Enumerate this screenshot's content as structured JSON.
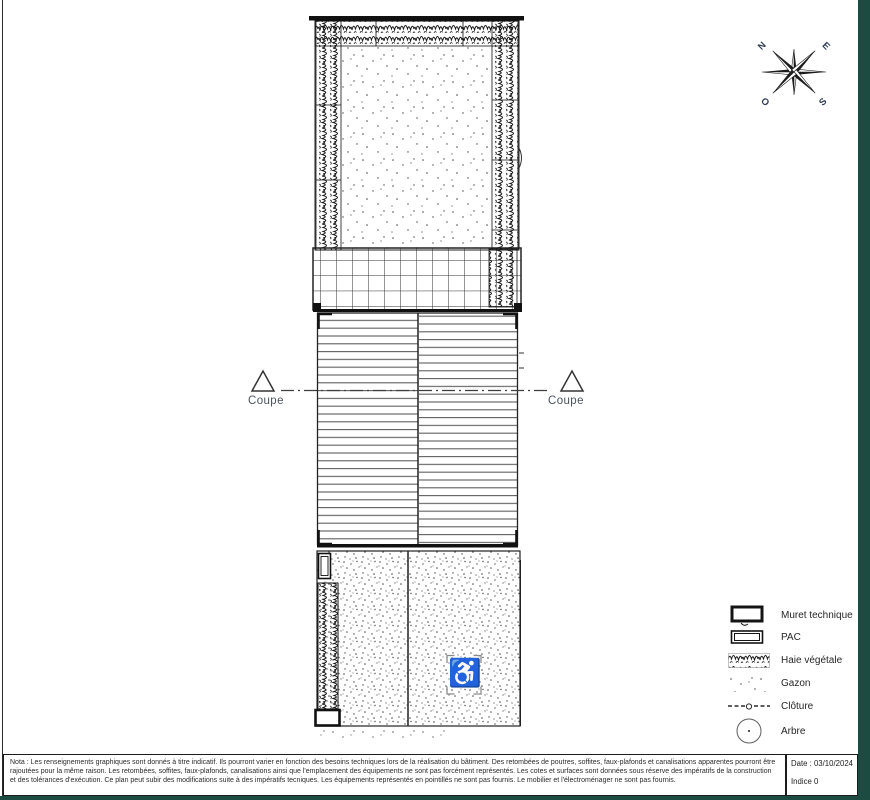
{
  "colors": {
    "frame_teal": "#1c4b42",
    "line_dark": "#1a1a1a",
    "roof_line_gray": "#5d5d5d",
    "label_gray_blue": "#4c545e"
  },
  "compass": {
    "n": "N",
    "e": "E",
    "s": "S",
    "o": "O"
  },
  "section_markers": {
    "left_label": "Coupe",
    "right_label": "Coupe"
  },
  "plan": {
    "accessible_icon": "♿"
  },
  "legend": {
    "items": [
      {
        "id": "muret-technique",
        "label": "Muret technique"
      },
      {
        "id": "pac",
        "label": "PAC"
      },
      {
        "id": "haie-vegetale",
        "label": "Haie végétale"
      },
      {
        "id": "gazon",
        "label": "Gazon"
      },
      {
        "id": "cloture",
        "label": "Clôture"
      },
      {
        "id": "arbre",
        "label": "Arbre"
      }
    ]
  },
  "titleblock": {
    "note": "Nota : Les renseignements graphiques sont donnés à titre indicatif. Ils pourront varier en fonction des besoins techniques lors de la réalisation du bâtiment. Des retombées de poutres, soffites, faux-plafonds et canalisations apparentes pourront être rajoutées pour la même raison. Les retombées, soffites, faux-plafonds, canalisations ainsi que l'emplacement des équipements ne sont pas forcément représentés. Les cotes et surfaces sont données sous réserve des impératifs de la construction et des tolérances d'exécution. Ce plan peut subir des modifications suite à des impératifs tecniques. Les équipements représentés en pointillés ne sont pas fournis. Le mobilier et l'électroménager ne sont pas fournis.",
    "date": "Date : 03/10/2024",
    "indice": "Indice 0"
  }
}
